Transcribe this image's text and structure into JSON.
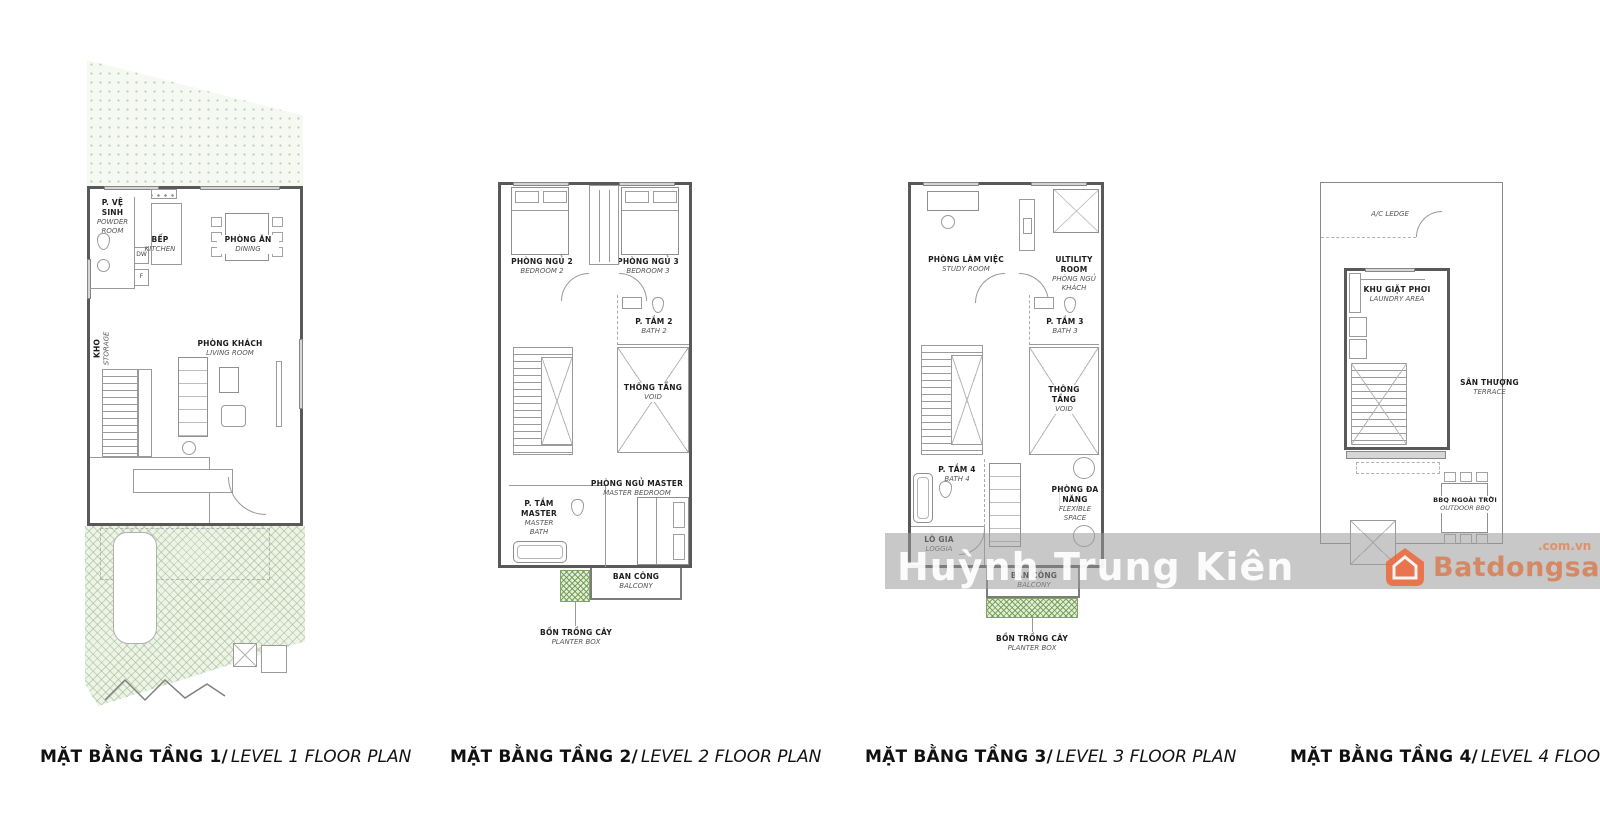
{
  "watermark": {
    "text": "Huỳnh Trung Kiên",
    "brand": "Batdongsan",
    "brand_suffix": ".com.vn",
    "band_color": "#9a9a9a",
    "brand_color": "#f0612f"
  },
  "captions": [
    {
      "vi": "MẶT BẰNG TẦNG 1/",
      "en": "LEVEL 1 FLOOR PLAN"
    },
    {
      "vi": "MẶT BẰNG TẦNG 2/",
      "en": "LEVEL 2 FLOOR PLAN"
    },
    {
      "vi": "MẶT BẰNG TẦNG 3/",
      "en": "LEVEL 3 FLOOR PLAN"
    },
    {
      "vi": "MẶT BẰNG TẦNG 4/",
      "en": "LEVEL 4 FLOOR PLAN"
    }
  ],
  "plans": [
    {
      "id": "level-1",
      "rooms": {
        "powder": {
          "vi": "P. VỆ SINH",
          "en": "POWDER ROOM"
        },
        "kitchen": {
          "vi": "BẾP",
          "en": "KITCHEN"
        },
        "dining": {
          "vi": "PHÒNG ĂN",
          "en": "DINING"
        },
        "living": {
          "vi": "PHÒNG KHÁCH",
          "en": "LIVING ROOM"
        },
        "storage": {
          "vi": "KHO",
          "en": "STORAGE"
        },
        "dw": "DW",
        "f": "F"
      }
    },
    {
      "id": "level-2",
      "rooms": {
        "bed2": {
          "vi": "PHÒNG NGỦ 2",
          "en": "BEDROOM 2"
        },
        "bed3": {
          "vi": "PHÒNG NGỦ 3",
          "en": "BEDROOM 3"
        },
        "bath2": {
          "vi": "P. TẮM 2",
          "en": "BATH 2"
        },
        "void": {
          "vi": "THÔNG TẦNG",
          "en": "VOID"
        },
        "master": {
          "vi": "PHÒNG NGỦ MASTER",
          "en": "MASTER BEDROOM"
        },
        "masterbath": {
          "vi": "P. TẮM MASTER",
          "en": "MASTER BATH"
        },
        "balcony": {
          "vi": "BAN CÔNG",
          "en": "BALCONY"
        },
        "planter": {
          "vi": "BỒN TRỒNG CÂY",
          "en": "PLANTER BOX"
        }
      }
    },
    {
      "id": "level-3",
      "rooms": {
        "study": {
          "vi": "PHÒNG LÀM VIỆC",
          "en": "STUDY ROOM"
        },
        "utility": {
          "en": "ULTILITY ROOM",
          "vi": "PHÒNG NGỦ KHÁCH"
        },
        "bath3": {
          "vi": "P. TẮM 3",
          "en": "BATH 3"
        },
        "void": {
          "vi": "THÔNG TẦNG",
          "en": "VOID"
        },
        "bath4": {
          "vi": "P. TẮM 4",
          "en": "BATH 4"
        },
        "loggia": {
          "vi": "LÔ GIA",
          "en": "LOGGIA"
        },
        "flex": {
          "vi": "PHÒNG ĐA NĂNG",
          "en": "FLEXIBLE SPACE"
        },
        "balcony": {
          "vi": "BAN CÔNG",
          "en": "BALCONY"
        },
        "planter": {
          "vi": "BỒN TRỒNG CÂY",
          "en": "PLANTER BOX"
        }
      }
    },
    {
      "id": "level-4",
      "rooms": {
        "ac": {
          "en": "A/C LEDGE"
        },
        "laundry": {
          "vi": "KHU GIẶT PHƠI",
          "en": "LAUNDRY AREA"
        },
        "terrace": {
          "vi": "SÂN THƯỢNG",
          "en": "TERRACE"
        },
        "bbq": {
          "vi": "BBQ NGOÀI TRỜI",
          "en": "OUTDOOR BBQ"
        }
      }
    }
  ],
  "colors": {
    "wall": "#595959",
    "thin_line": "#9b9b9b",
    "garden_green": "#cfe0c4",
    "planter_green": "#85a268",
    "text": "#111111"
  }
}
